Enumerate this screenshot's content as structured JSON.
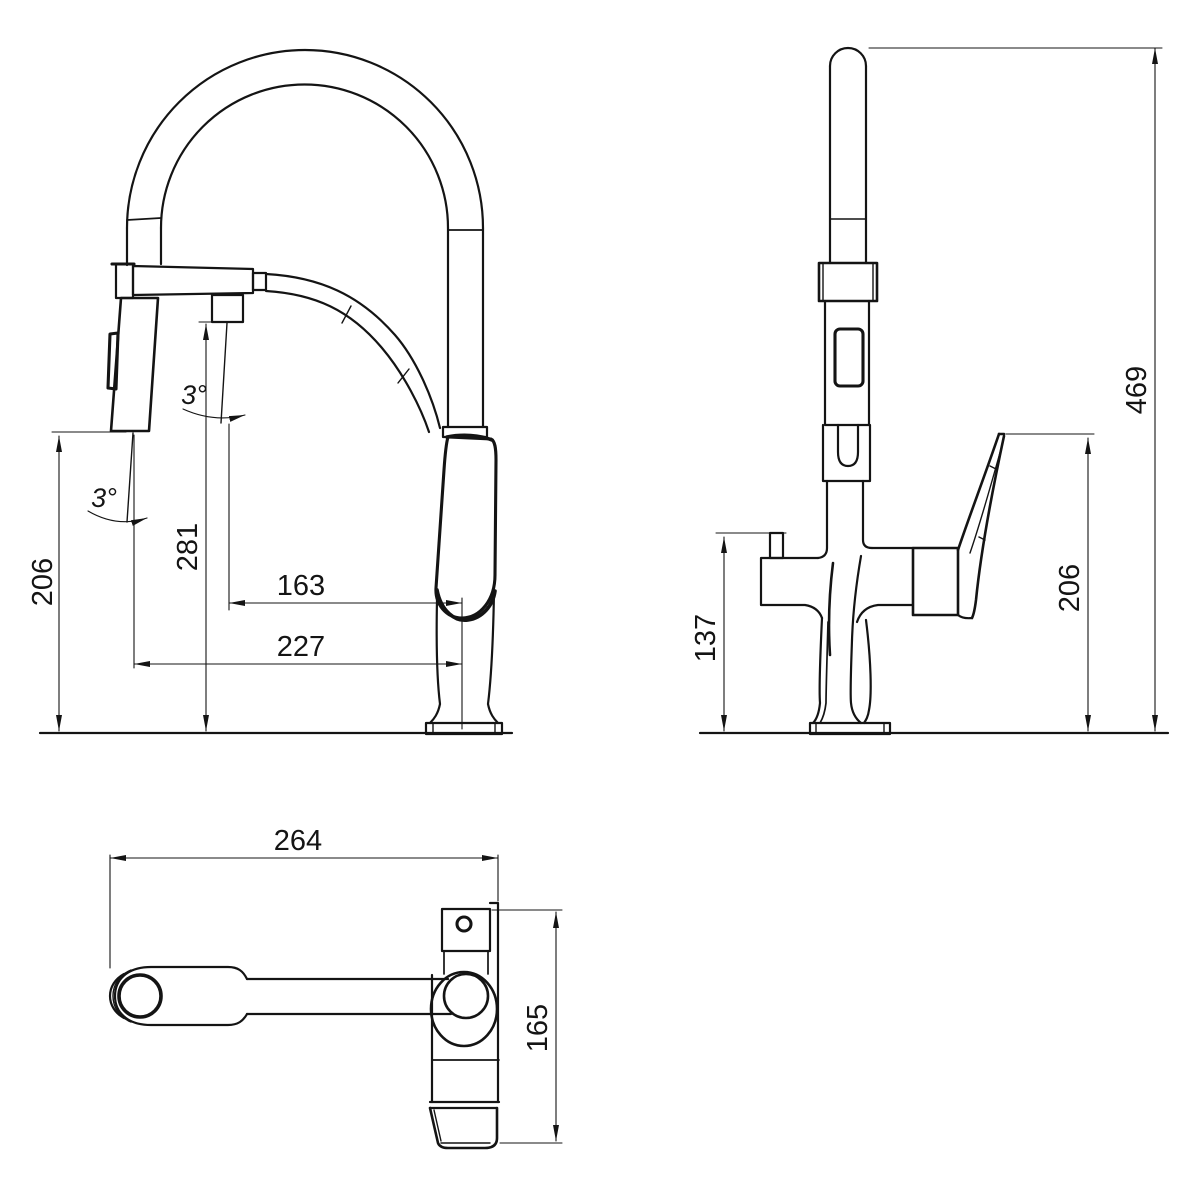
{
  "drawing": {
    "type": "technical-dimension-drawing",
    "subject": "kitchen faucet with pull-down spray, three orthographic views",
    "colors": {
      "line": "#141414",
      "background": "#ffffff"
    },
    "views": {
      "front": {
        "name": "front view",
        "dims": {
          "spray_height": "206",
          "spout_height": "281",
          "spout_reach": "163",
          "spray_reach": "227",
          "spout_angle": "3°",
          "spray_angle": "3°"
        }
      },
      "side": {
        "name": "side view",
        "dims": {
          "total_height": "469",
          "handle_height": "206",
          "outlet_height": "137"
        }
      },
      "top": {
        "name": "top view",
        "dims": {
          "length": "264",
          "depth": "165"
        }
      }
    }
  }
}
